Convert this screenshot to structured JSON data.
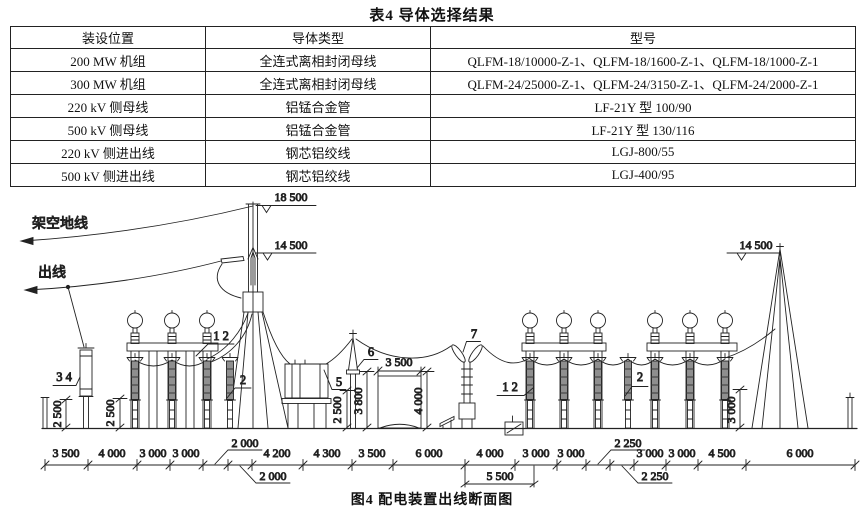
{
  "table": {
    "title": "表4  导体选择结果",
    "columns": [
      "装设位置",
      "导体类型",
      "型号"
    ],
    "rows": [
      [
        "200 MW 机组",
        "全连式离相封闭母线",
        "QLFM-18/10000-Z-1、QLFM-18/1600-Z-1、QLFM-18/1000-Z-1"
      ],
      [
        "300 MW 机组",
        "全连式离相封闭母线",
        "QLFM-24/25000-Z-1、QLFM-24/3150-Z-1、QLFM-24/2000-Z-1"
      ],
      [
        "220 kV 侧母线",
        "铝锰合金管",
        "LF-21Y 型 100/90"
      ],
      [
        "500 kV 侧母线",
        "铝锰合金管",
        "LF-21Y 型 130/116"
      ],
      [
        "220 kV 侧进出线",
        "钢芯铝绞线",
        "LGJ-800/55"
      ],
      [
        "500 kV 侧进出线",
        "钢芯铝绞线",
        "LGJ-400/95"
      ]
    ]
  },
  "figure": {
    "caption": "图4  配电装置出线断面图",
    "wire_labels": {
      "overhead_ground_wire": "架空地线",
      "outgoing_line": "出线"
    },
    "elevations": {
      "left_tower_top": "18 500",
      "left_tower_arm": "14 500",
      "right_tower_top": "14 500"
    },
    "callouts": {
      "c3_4": "3 4",
      "c1_2_left": "1 2",
      "c2_left": "2",
      "c5": "5",
      "c6": "6",
      "c7": "7",
      "c1_2_right": "1 2",
      "c2_right": "2"
    },
    "v_dims": {
      "left_2500_a": "2 500",
      "left_2500_b": "2 500",
      "mid_2500": "2 500",
      "mid_3800": "3 800",
      "mid_4000": "4 000",
      "right_3000": "3 000"
    },
    "h_dims": {
      "mid_3500": "3 500"
    },
    "leader_dims": {
      "d2000_above": "2 000",
      "d2000_below": "2 000",
      "d2250_above": "2 250",
      "d2250_below": "2 250",
      "d5500": "5 500"
    },
    "bottom_dims": [
      "3 500",
      "4 000",
      "3 000",
      "3 000",
      "4 200",
      "4 300",
      "3 500",
      "6 000",
      "4 000",
      "3 000",
      "3 000",
      "3 000",
      "3 000",
      "4 500",
      "6 000"
    ]
  }
}
